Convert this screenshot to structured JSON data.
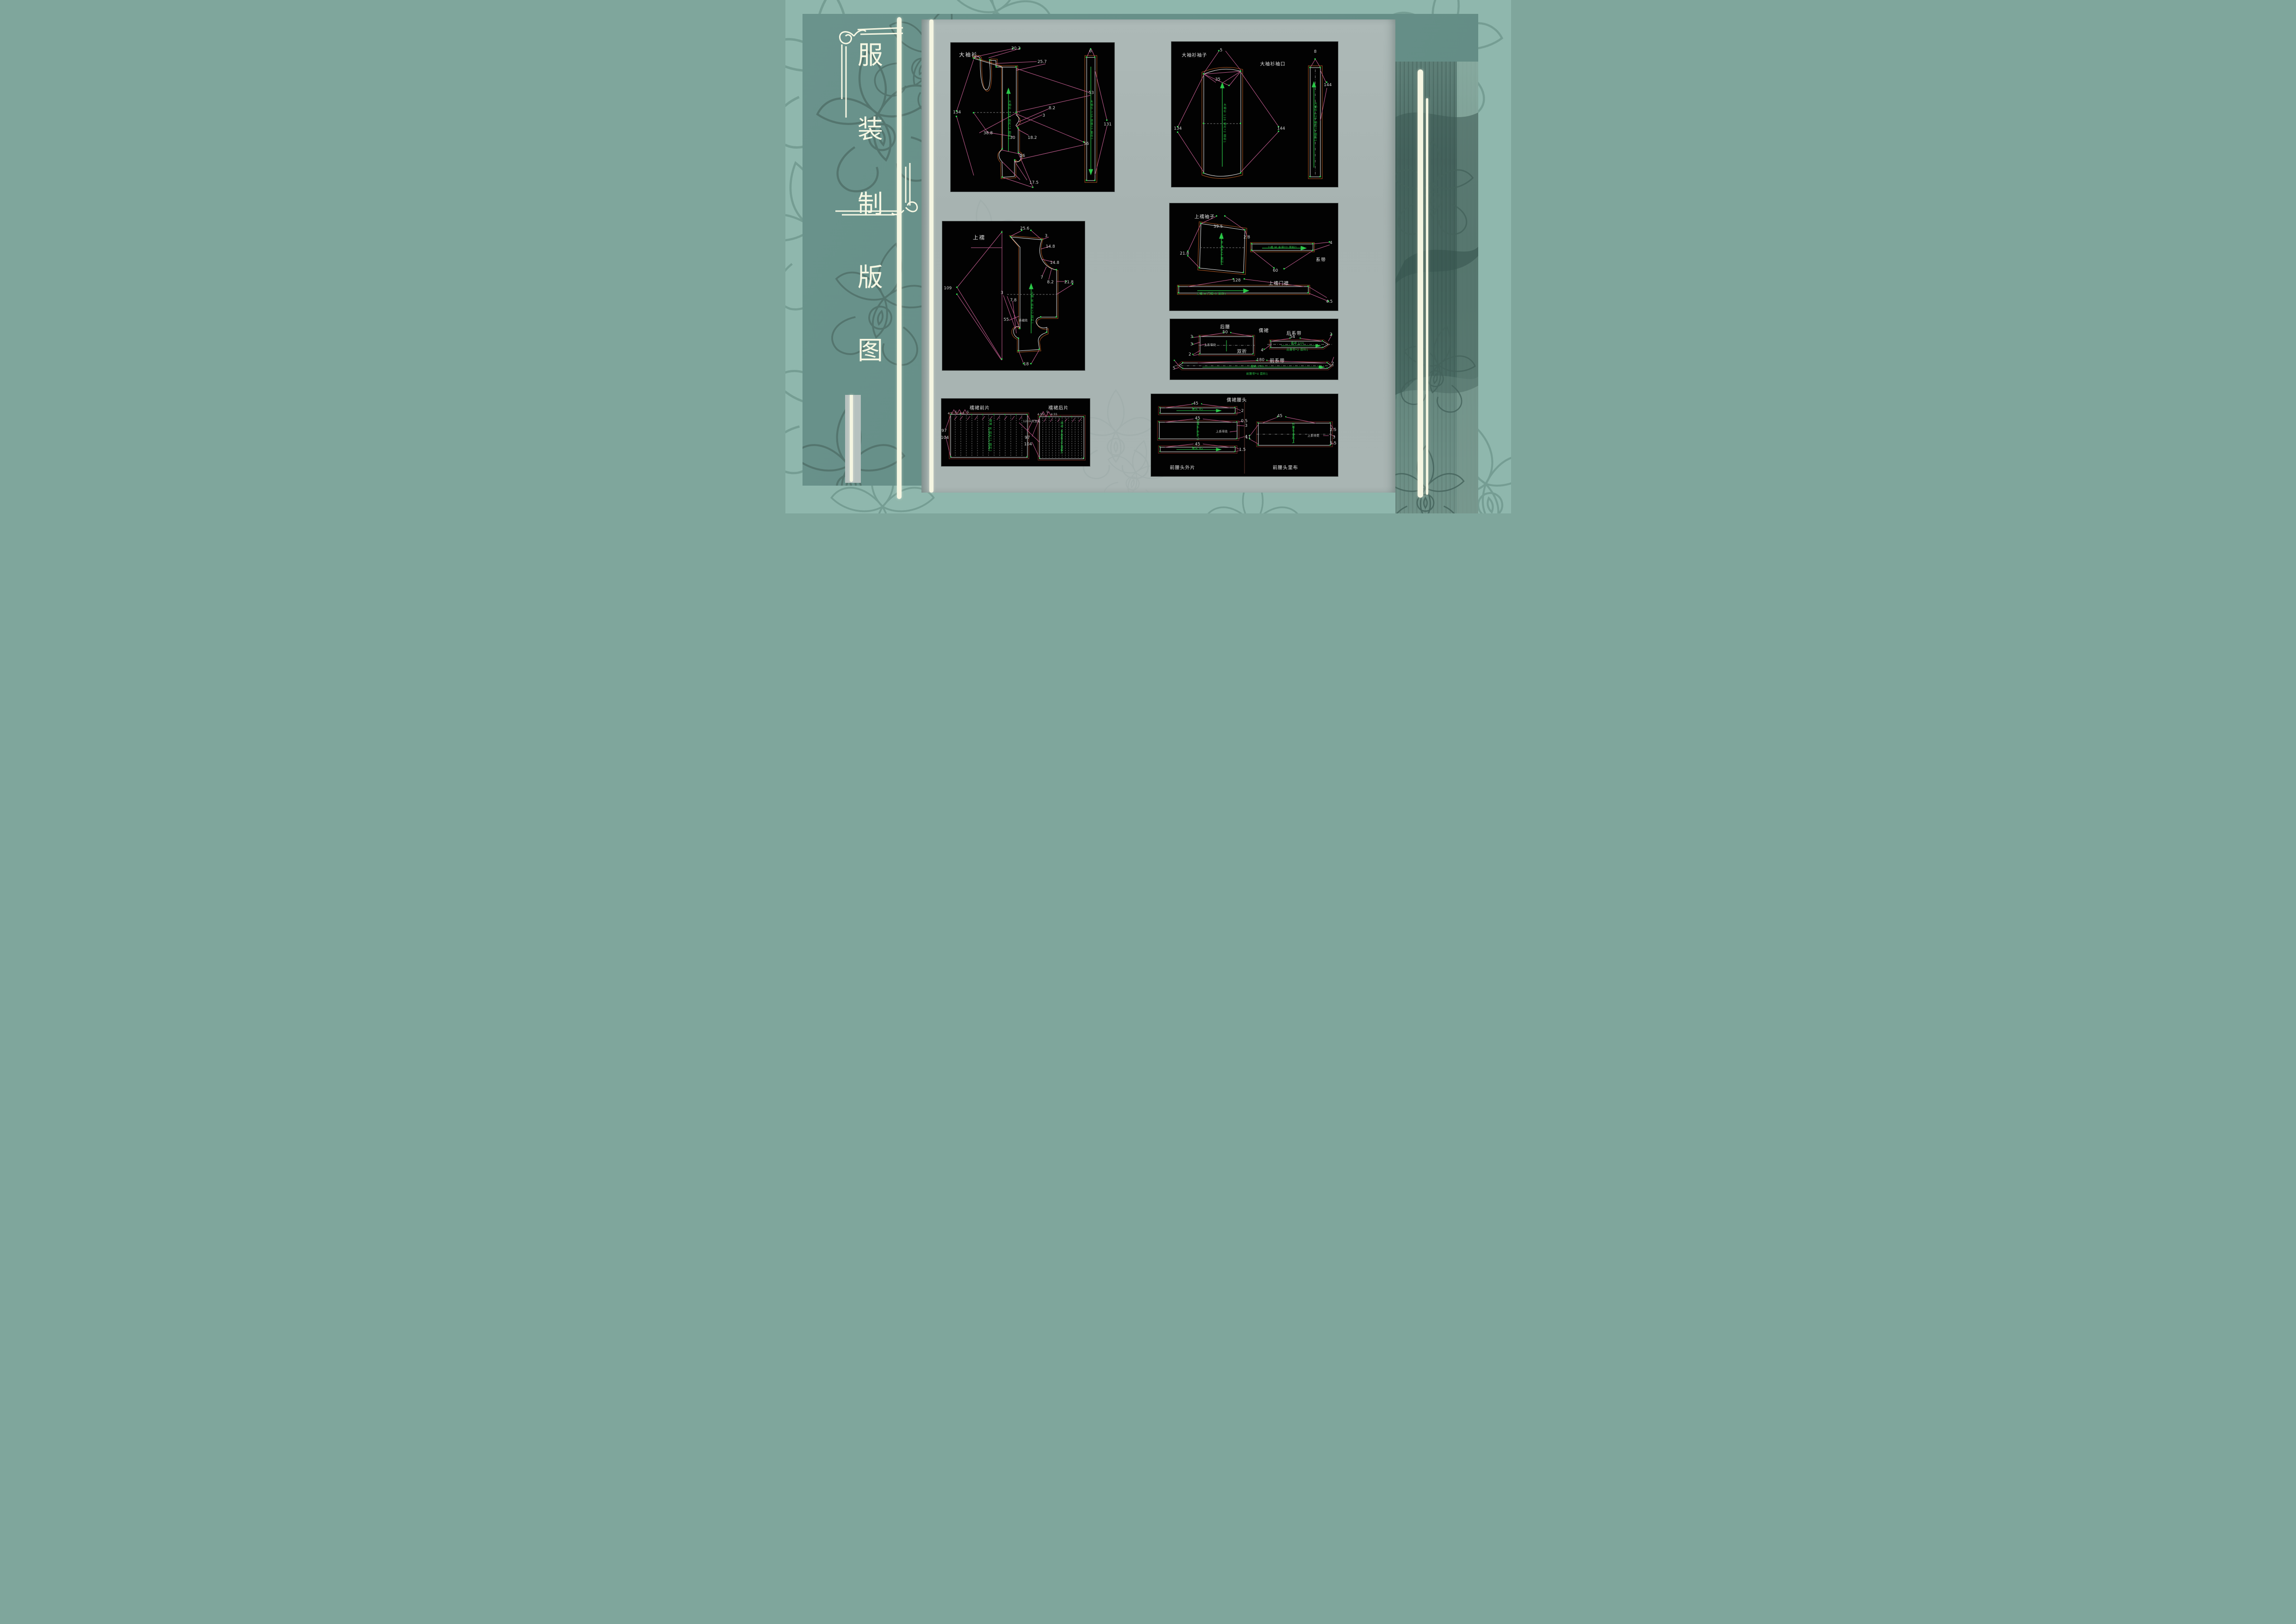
{
  "slide_title": {
    "text": "服装制版图",
    "chars": [
      "服",
      "装",
      "制",
      "版",
      "图"
    ]
  },
  "colors": {
    "background_teal": "#8fb7ad",
    "panel_teal": "#67908a",
    "page_gray": "#a9b5b3",
    "ribbon_cream": "#f5f6e2",
    "cad_outline_white": "#e6e6e6",
    "cad_seam_orange": "#a85420",
    "cad_dimension_pink": "#c75f93",
    "cad_grain_green": "#2bc948",
    "cad_background": "#020202"
  },
  "diagrams": [
    {
      "id": "daxiushan",
      "labels": [
        {
          "t": "大袖衫",
          "x": 11,
          "y": 8,
          "k": "title"
        },
        {
          "t": "20.2",
          "x": 40,
          "y": 4
        },
        {
          "t": "25.7",
          "x": 56,
          "y": 13
        },
        {
          "t": "53",
          "x": 86,
          "y": 34
        },
        {
          "t": "134",
          "x": 4,
          "y": 47
        },
        {
          "t": "38.8",
          "x": 23,
          "y": 61
        },
        {
          "t": "30",
          "x": 38,
          "y": 64
        },
        {
          "t": "18.2",
          "x": 50,
          "y": 64
        },
        {
          "t": "3",
          "x": 57,
          "y": 49
        },
        {
          "t": "8.2",
          "x": 62,
          "y": 44
        },
        {
          "t": "56",
          "x": 83,
          "y": 68
        },
        {
          "t": "26",
          "x": 44,
          "y": 76
        },
        {
          "t": "17.5",
          "x": 51,
          "y": 94
        },
        {
          "t": "6",
          "x": 85.5,
          "y": 6
        },
        {
          "t": "131",
          "x": 96,
          "y": 55
        },
        {
          "t": "大袖衫 120 衣片*2 面料1",
          "x": 36,
          "y": 52,
          "k": "green-v"
        },
        {
          "t": "大袖衫 120 领缘*2 面料1",
          "x": 86,
          "y": 52,
          "k": "green-v"
        }
      ]
    },
    {
      "id": "daxiushan-xiuzi",
      "labels": [
        {
          "t": "大袖衫袖子",
          "x": 14,
          "y": 9,
          "k": "stitle"
        },
        {
          "t": "大袖衫袖口",
          "x": 61,
          "y": 15,
          "k": "stitle"
        },
        {
          "t": "5",
          "x": 30,
          "y": 6
        },
        {
          "t": "35",
          "x": 28,
          "y": 26
        },
        {
          "t": "134",
          "x": 4,
          "y": 60
        },
        {
          "t": "144",
          "x": 66,
          "y": 60
        },
        {
          "t": "8",
          "x": 86.5,
          "y": 7
        },
        {
          "t": "144",
          "x": 94,
          "y": 30
        },
        {
          "t": "大袖衫 120 袖片*2 面料1",
          "x": 32,
          "y": 56,
          "k": "green-v"
        },
        {
          "t": "大袖衫 120 袖口*2 面料1",
          "x": 86.5,
          "y": 55,
          "k": "green-v"
        }
      ]
    },
    {
      "id": "shangru",
      "labels": [
        {
          "t": "上襦",
          "x": 26,
          "y": 11,
          "k": "title"
        },
        {
          "t": "25.6",
          "x": 58,
          "y": 5
        },
        {
          "t": "3",
          "x": 73,
          "y": 10
        },
        {
          "t": "14.8",
          "x": 76,
          "y": 17
        },
        {
          "t": "14.8",
          "x": 79,
          "y": 28
        },
        {
          "t": "7",
          "x": 70,
          "y": 38
        },
        {
          "t": "8.2",
          "x": 76,
          "y": 41
        },
        {
          "t": "21.8",
          "x": 89,
          "y": 41
        },
        {
          "t": "109",
          "x": 4,
          "y": 45
        },
        {
          "t": "3",
          "x": 42,
          "y": 48
        },
        {
          "t": "7.8",
          "x": 50,
          "y": 53
        },
        {
          "t": "55",
          "x": 45,
          "y": 66
        },
        {
          "t": "18",
          "x": 59,
          "y": 96
        },
        {
          "t": "系缝处",
          "x": 57,
          "y": 66,
          "k": "tiny"
        },
        {
          "t": "上襦 M 衣片*2 面料1",
          "x": 63,
          "y": 58,
          "k": "green-v"
        }
      ]
    },
    {
      "id": "shangru-xiuzi",
      "labels": [
        {
          "t": "上襦袖子",
          "x": 21,
          "y": 12,
          "k": "stitle"
        },
        {
          "t": "39.5",
          "x": 29,
          "y": 22
        },
        {
          "t": "2.8",
          "x": 46,
          "y": 32
        },
        {
          "t": "21.8",
          "x": 9,
          "y": 47
        },
        {
          "t": "4",
          "x": 96,
          "y": 37
        },
        {
          "t": "系带",
          "x": 90,
          "y": 52,
          "k": "stitle"
        },
        {
          "t": "60",
          "x": 63,
          "y": 63
        },
        {
          "t": "上襦门襟",
          "x": 65,
          "y": 74,
          "k": "stitle"
        },
        {
          "t": "128",
          "x": 40,
          "y": 72
        },
        {
          "t": "4.5",
          "x": 95,
          "y": 92
        },
        {
          "t": "上襦 M 袖片*2 面料1",
          "x": 31,
          "y": 43,
          "k": "green-v"
        },
        {
          "t": "上襦 M  系带*2 面料1",
          "x": 67,
          "y": 41,
          "k": "green-h"
        },
        {
          "t": "上襦 M  门襟*2 面料1",
          "x": 25,
          "y": 84,
          "k": "green-h"
        }
      ]
    },
    {
      "id": "ruqun-yaodai",
      "labels": [
        {
          "t": "后腰",
          "x": 33,
          "y": 12,
          "k": "stitle"
        },
        {
          "t": "儒裙",
          "x": 56,
          "y": 18,
          "k": "stitle"
        },
        {
          "t": "后系带",
          "x": 74,
          "y": 23,
          "k": "stitle"
        },
        {
          "t": "前系带",
          "x": 64,
          "y": 68,
          "k": "stitle"
        },
        {
          "t": "50",
          "x": 33,
          "y": 22
        },
        {
          "t": "3",
          "x": 13,
          "y": 30
        },
        {
          "t": "3",
          "x": 13,
          "y": 42
        },
        {
          "t": "上系带处",
          "x": 24,
          "y": 42,
          "k": "tiny"
        },
        {
          "t": "2",
          "x": 12,
          "y": 59
        },
        {
          "t": "双折",
          "x": 43,
          "y": 53,
          "k": "stitle"
        },
        {
          "t": "54",
          "x": 73,
          "y": 30
        },
        {
          "t": "2",
          "x": 96,
          "y": 26
        },
        {
          "t": "4",
          "x": 55,
          "y": 52
        },
        {
          "t": "儒裙  120",
          "x": 76,
          "y": 40,
          "k": "green-h"
        },
        {
          "t": "后腰带*2  面料1",
          "x": 76,
          "y": 50,
          "k": "green-h"
        },
        {
          "t": "180",
          "x": 54,
          "y": 68
        },
        {
          "t": "2",
          "x": 97,
          "y": 74
        },
        {
          "t": "5",
          "x": 2.5,
          "y": 82
        },
        {
          "t": "儒裙  120",
          "x": 52,
          "y": 78,
          "k": "green-h"
        },
        {
          "t": "前腰带*4  面料1",
          "x": 52,
          "y": 90,
          "k": "green-h"
        }
      ]
    },
    {
      "id": "ruqun-qunpian",
      "labels": [
        {
          "t": "襦裙前片",
          "x": 26,
          "y": 13,
          "k": "stitle"
        },
        {
          "t": "襦裙后片",
          "x": 79,
          "y": 13,
          "k": "stitle"
        },
        {
          "t": "4.5",
          "x": 6,
          "y": 22,
          "k": "tiny"
        },
        {
          "t": "5",
          "x": 10,
          "y": 20,
          "k": "tiny"
        },
        {
          "t": "4.5",
          "x": 14,
          "y": 22,
          "k": "tiny"
        },
        {
          "t": "5",
          "x": 18,
          "y": 20,
          "k": "tiny"
        },
        {
          "t": "4.55",
          "x": 67,
          "y": 23,
          "k": "tiny"
        },
        {
          "t": "5",
          "x": 71.5,
          "y": 20,
          "k": "tiny"
        },
        {
          "t": "4.55",
          "x": 76,
          "y": 23,
          "k": "tiny"
        },
        {
          "t": "12cm开叉处",
          "x": 61,
          "y": 33,
          "k": "tiny"
        },
        {
          "t": "97",
          "x": 2,
          "y": 48
        },
        {
          "t": "104",
          "x": 2.5,
          "y": 58
        },
        {
          "t": "97",
          "x": 58,
          "y": 58
        },
        {
          "t": "104",
          "x": 58.5,
          "y": 68
        },
        {
          "t": "襦裙 M 前片*1 面料1",
          "x": 33,
          "y": 55,
          "k": "green-v"
        },
        {
          "t": "襦裙 M 后片*1 面料1",
          "x": 81,
          "y": 58,
          "k": "green-v"
        }
      ]
    },
    {
      "id": "ruqun-yaotou",
      "labels": [
        {
          "t": "儒裙腰头",
          "x": 46,
          "y": 7,
          "k": "stitle"
        },
        {
          "t": "前腰头外片",
          "x": 17,
          "y": 89,
          "k": "stitle"
        },
        {
          "t": "前腰头里布",
          "x": 72,
          "y": 89,
          "k": "stitle"
        },
        {
          "t": "45",
          "x": 24,
          "y": 12
        },
        {
          "t": "2",
          "x": 49,
          "y": 21
        },
        {
          "t": "45",
          "x": 25,
          "y": 30
        },
        {
          "t": "0.5",
          "x": 50,
          "y": 33
        },
        {
          "t": "3",
          "x": 51,
          "y": 39
        },
        {
          "t": "上系带处",
          "x": 38,
          "y": 45,
          "k": "tiny"
        },
        {
          "t": "4",
          "x": 51,
          "y": 52
        },
        {
          "t": "45",
          "x": 25,
          "y": 61
        },
        {
          "t": "1.5",
          "x": 49,
          "y": 68
        },
        {
          "t": "45",
          "x": 69,
          "y": 27
        },
        {
          "t": "11",
          "x": 52,
          "y": 53
        },
        {
          "t": "2.5",
          "x": 97.5,
          "y": 44
        },
        {
          "t": "上系带处",
          "x": 87,
          "y": 50,
          "k": "tiny"
        },
        {
          "t": "3",
          "x": 98,
          "y": 53
        },
        {
          "t": "5.5",
          "x": 97.5,
          "y": 60
        },
        {
          "t": "腰头 45",
          "x": 25,
          "y": 18,
          "k": "green-h"
        },
        {
          "t": "前腰头 外片*1",
          "x": 25,
          "y": 44,
          "k": "green-v"
        },
        {
          "t": "腰头 45",
          "x": 25,
          "y": 66,
          "k": "green-h"
        },
        {
          "t": "前腰头 里布*1",
          "x": 76,
          "y": 48,
          "k": "green-v"
        }
      ]
    }
  ]
}
